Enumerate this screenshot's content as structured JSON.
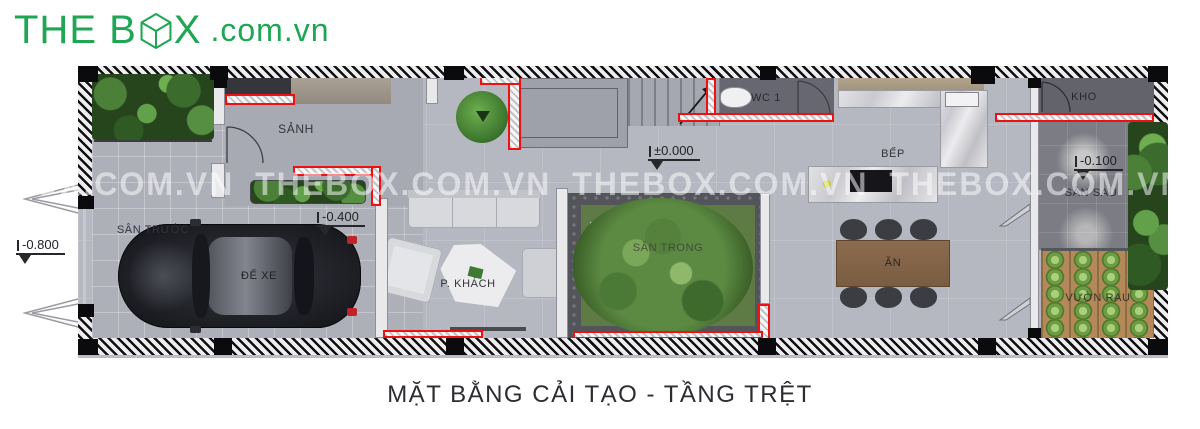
{
  "logo": {
    "prefix": "THE B",
    "x_letter": "X",
    "domain": ".com.vn",
    "color": "#1ea653",
    "box_icon": "wireframe-cube"
  },
  "caption": "MẶT BẰNG CẢI TẠO - TẦNG TRỆT",
  "watermark": "THEBOX.COM.VN   THEBOX.COM.VN   THEBOX.COM.VN   THEBOX.COM.VN   THEBOX.COM.VN   THEBOX.COM.VN",
  "rooms": {
    "san_truoc": "SÂN TRƯỚC",
    "de_xe": "ĐỂ XE",
    "sanh": "SẢNH",
    "wc1": "WC 1",
    "kho": "KHO",
    "bep": "BẾP",
    "san_sau": "SÂN SAU",
    "p_khach": "P. KHÁCH",
    "san_trong": "SÂN TRONG",
    "an": "ĂN",
    "vuon_rau": "VƯỜN RAU"
  },
  "elevations": {
    "outside_front": "-0.800",
    "garage": "-0.400",
    "ground": "±0.000",
    "backyard": "-0.100"
  },
  "colors": {
    "highlight_red": "#ee1111",
    "floor_main": "#b5b7c1",
    "floor_dark": "#6a6b73",
    "grass": "#5f7b45",
    "soil": "#b4895a"
  }
}
